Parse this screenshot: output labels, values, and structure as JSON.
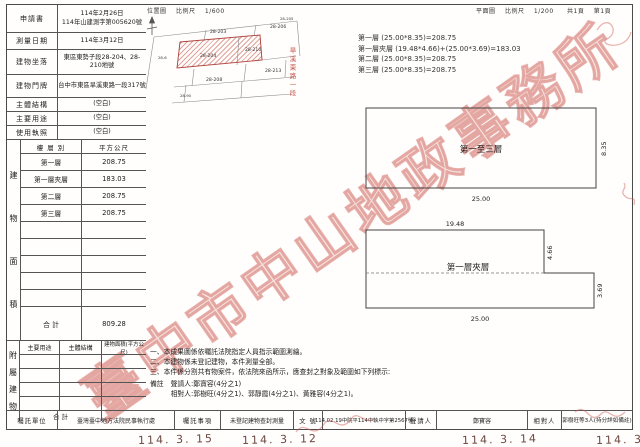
{
  "header": {
    "location_map_title": "位置圖",
    "location_map_scale_label": "比例尺",
    "location_map_scale": "1/600",
    "plan_title": "平面圖",
    "plan_scale_label": "比例尺",
    "plan_scale": "1/200",
    "page_total": "共1頁",
    "page_no": "第1頁"
  },
  "info": {
    "rows": [
      {
        "label": "申請書",
        "value": "114年2月26日\n114年山建測字第005620號"
      },
      {
        "label": "測量日期",
        "value": "114年3月12日"
      },
      {
        "label": "建物坐落",
        "value": "東區東勢子段28-204、28-210地號"
      },
      {
        "label": "建物門牌",
        "value": "台中市東區旱溪東路一段317號"
      },
      {
        "label": "主體結構",
        "value": "(空白)"
      },
      {
        "label": "主要用途",
        "value": "(空白)"
      },
      {
        "label": "使用執照",
        "value": "(空白)"
      }
    ]
  },
  "floor_table": {
    "vertical_label": [
      "建",
      "物",
      "面",
      "積"
    ],
    "col_floor": "樓 層 別",
    "col_area": "平方公尺",
    "rows": [
      {
        "name": "第一層",
        "area": "208.75"
      },
      {
        "name": "第一層夾層",
        "area": "183.03"
      },
      {
        "name": "第二層",
        "area": "208.75"
      },
      {
        "name": "第三層",
        "area": "208.75"
      }
    ],
    "total_label": "合  計",
    "total": "809.28"
  },
  "annex_table": {
    "vertical_label": [
      "附",
      "屬",
      "建",
      "物"
    ],
    "headers": [
      "主要用途",
      "主體結構",
      "建物面積(平方公尺)"
    ],
    "total_label": "合  計"
  },
  "calc_lines": [
    "第一層 (25.00*8.35)=208.75",
    "第一層夾層 (19.48*4.66)+(25.00*3.69)=183.03",
    "第二層 (25.00*8.35)=208.75",
    "第三層 (25.00*8.35)=208.75"
  ],
  "location_map": {
    "street_label": "旱溪東路一段",
    "parcels": [
      "28-203",
      "28-206",
      "28-205",
      "28-204",
      "28-210",
      "28-6",
      "28-208",
      "28-213",
      "28-90"
    ],
    "highlight_color": "#c7554a"
  },
  "plans": {
    "upper": {
      "label": "第一至三層",
      "width": "25.00",
      "height": "8.35"
    },
    "lower": {
      "label": "第一層夾層",
      "top_width": "19.48",
      "upper_height": "4.66",
      "lower_height": "3.69",
      "bottom_width": "25.00"
    }
  },
  "notes": [
    "一、本成果圖係依囑託法院指定人員指示範圍測繪。",
    "二、本建物係未登記建物，本件測量全部。",
    "三、本件係分割共有物案件，依法院來函所示，應查封之對象及範圍如下列標示:"
  ],
  "remark": {
    "label": "備註",
    "line1": "聲請人:鄭寶容(4分之1)",
    "line2": "相對人:郭樹旺(4分之1)、郭靜霞(4分之1)、黃雅容(4分之1)。"
  },
  "footer": {
    "unit_label": "囑託單位",
    "unit": "臺灣臺中地方法院民事執行處",
    "matter_label": "囑託事項",
    "matter": "未登記建物查封測量",
    "doc_label": "文  號",
    "doc": "114.02.19中院平114中執中字第2567號",
    "applicant_label": "聲請人",
    "applicant": "鄭寶容",
    "respondent_label": "相對人",
    "respondent": "郭樹旺等3人(持分詳如備註)"
  },
  "watermark": "臺中市中山地政事務所",
  "stamps": [
    "114. 3. 15",
    "114. 3. 12",
    "114. 3. 14",
    "114. 3. 12"
  ]
}
